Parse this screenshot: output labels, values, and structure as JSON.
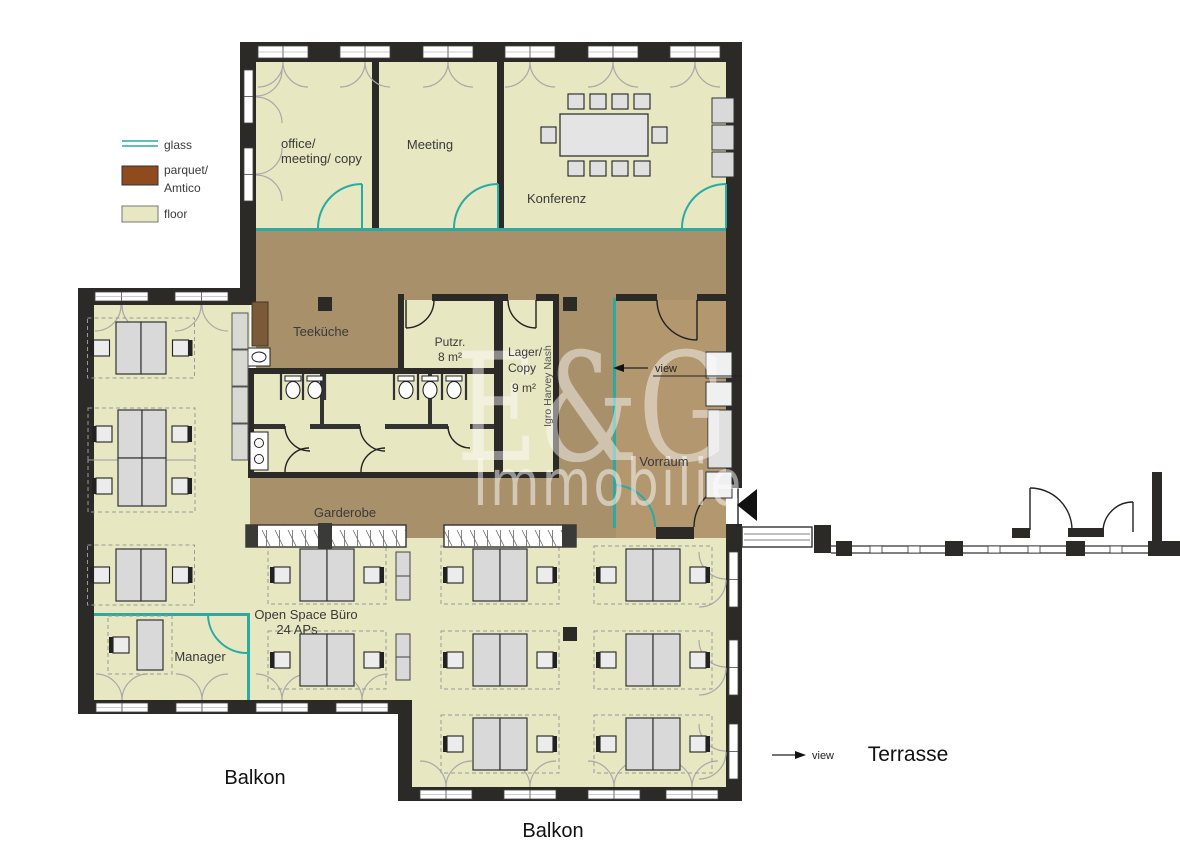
{
  "legend": {
    "glass": "glass",
    "parquet_l1": "parquet/",
    "parquet_l2": "Amtico",
    "floor": "floor"
  },
  "rooms": {
    "office_l1": "office/",
    "office_l2": "meeting/ copy",
    "meeting": "Meeting",
    "konferenz": "Konferenz",
    "teekueche": "Teeküche",
    "putzr_l1": "Putzr.",
    "putzr_l2": "8 m²",
    "lager_l1": "Lager/",
    "lager_l2": "Copy",
    "lager_l3": "9 m²",
    "vorraum": "Vorraum",
    "garderobe": "Garderobe",
    "open_space_l1": "Open Space Büro",
    "open_space_l2": "24 APs",
    "manager": "Manager"
  },
  "outdoor": {
    "balkon_left": "Balkon",
    "balkon_bottom": "Balkon",
    "terrasse": "Terrasse"
  },
  "annotations": {
    "view_left": "view",
    "view_right": "view",
    "vertical_note": "Igro Harvey Nash"
  },
  "watermark": {
    "line1": "E&G",
    "line2": "Immobilien"
  },
  "colors": {
    "glass": "#2aaaa4",
    "parquet_legend": "#8f4a1d",
    "floor": "#e7e7c2",
    "corridor": "#a8906b",
    "vorraum": "#b2976f",
    "wall": "#2b2a27"
  }
}
